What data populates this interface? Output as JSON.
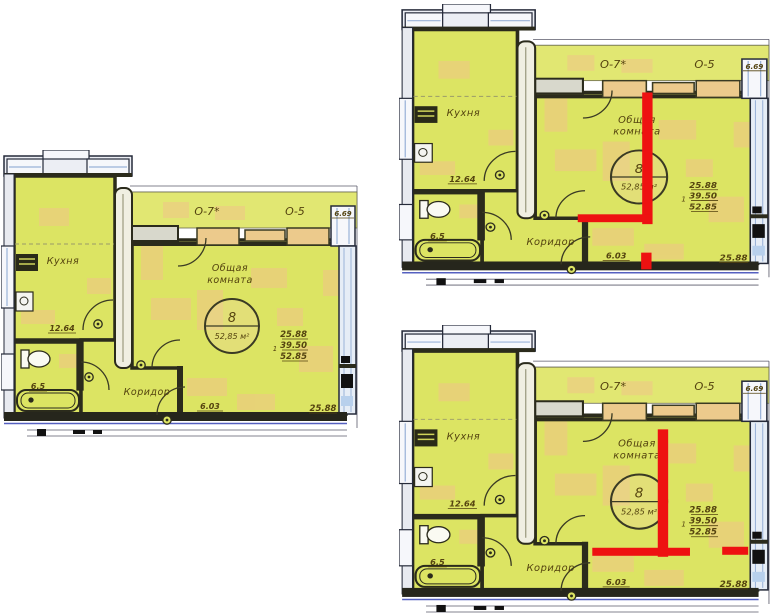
{
  "page": {
    "width": 770,
    "height": 616,
    "background": "#ffffff"
  },
  "colors": {
    "room_fill": "#dce463",
    "loggia_fill": "#e1e772",
    "accent_patch": "#f1c588",
    "wall_dark": "#2b2b1c",
    "window_fill": "#f6f7fb",
    "window_frame_blue": "#3a4a9a",
    "window_inner_blue": "#9ab2d8",
    "sill_tan": "#ecca8c",
    "outer_line": "#5a5a6a",
    "blue_base_line": "#5560c0",
    "text_brown": "#54430f",
    "annotation_red": "#ee1111"
  },
  "plan_labels": {
    "kitchen": "Кухня",
    "kitchen_area": "12.64",
    "bathroom_area": "6.5",
    "corridor": "Коридор",
    "corridor_area": "6.03",
    "room_title_line1": "Общая",
    "room_title_line2": "комната",
    "unit_number": "8",
    "unit_area": "52,85 м²",
    "window_left": "О-7*",
    "window_right": "О-5",
    "window_dim": "6.69",
    "area_stack_prefix": "1",
    "area_stack_1": "25.88",
    "area_stack_2": "39.50",
    "area_stack_3": "52.85",
    "room_width_bottom": "25.88"
  },
  "plans": [
    {
      "name": "plan-left",
      "annotations": []
    },
    {
      "name": "plan-top-right",
      "annotations": [
        {
          "x": 234,
          "y": 90,
          "w": 10,
          "h": 134
        },
        {
          "x": 172,
          "y": 214,
          "w": 71,
          "h": 8
        },
        {
          "x": 233,
          "y": 253,
          "w": 10,
          "h": 17
        }
      ]
    },
    {
      "name": "plan-bottom-right",
      "annotations": [
        {
          "x": 249,
          "y": 104,
          "w": 10,
          "h": 127
        },
        {
          "x": 186,
          "y": 222,
          "w": 94,
          "h": 8
        },
        {
          "x": 311,
          "y": 221,
          "w": 25,
          "h": 8
        }
      ]
    }
  ]
}
